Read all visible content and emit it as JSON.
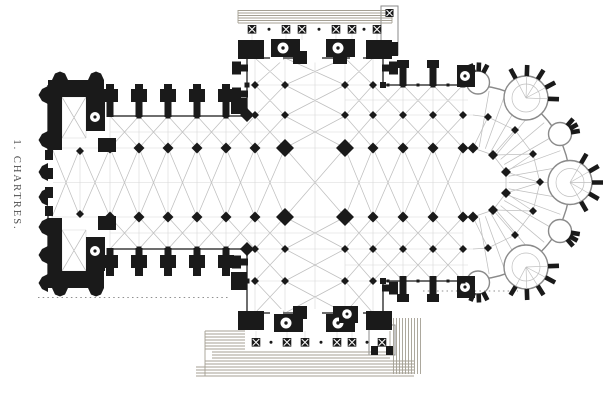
{
  "figure": {
    "caption": "1. CHARTRES.",
    "type_label": "cathedral-ground-plan"
  },
  "colors": {
    "paper": "#ffffff",
    "ink": "#1a1a1a",
    "vault_line": "#bfbfbf",
    "grid_line": "#d8d8d8",
    "wall": "#6e6e6e",
    "chapel_wall": "#8a8a8a",
    "steps_hatch": "#a49f93",
    "dotted": "#8f8f8f",
    "caption_text": "#4d4d4d"
  }
}
